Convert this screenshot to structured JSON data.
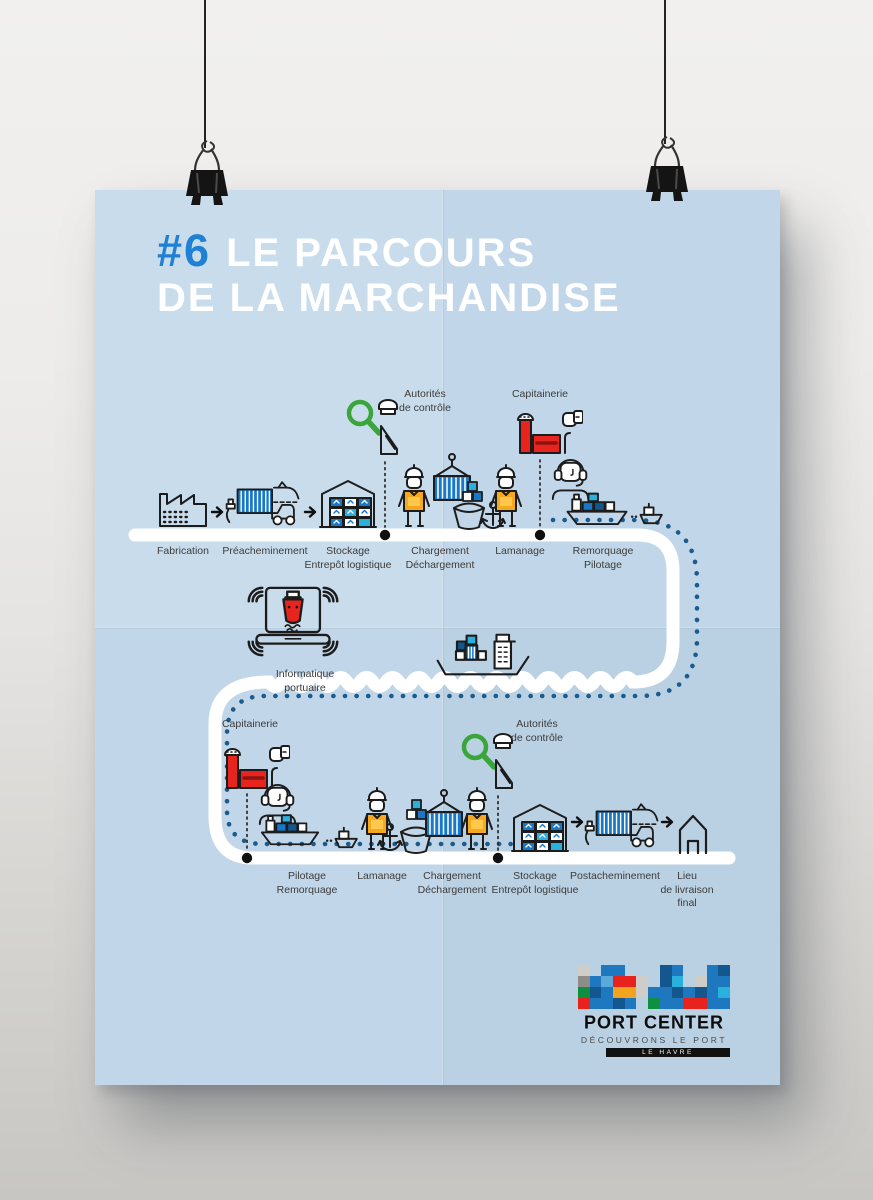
{
  "poster": {
    "title": {
      "number": "#6",
      "line1": "LE PARCOURS",
      "line2": "DE LA MARCHANDISE"
    },
    "top_route": {
      "callouts": {
        "autorites": "Autorités\nde contrôle",
        "capitainerie": "Capitainerie"
      },
      "steps": [
        "Fabrication",
        "Préacheminement",
        "Stockage\nEntrepôt logistique",
        "Chargement\nDéchargement",
        "Lamanage",
        "Remorquage\nPilotage"
      ]
    },
    "middle": {
      "informatique": "Informatique\nportuaire"
    },
    "bottom_route": {
      "callouts": {
        "capitainerie": "Capitainerie",
        "autorites": "Autorités\nde contrôle"
      },
      "steps": [
        "Pilotage\nRemorquage",
        "Lamanage",
        "Chargement\nDéchargement",
        "Stockage\nEntrepôt logistique",
        "Postacheminement",
        "Lieu\nde livraison\nfinal"
      ]
    },
    "logo": {
      "name": "PORT CENTER",
      "tagline": "DÉCOUVRONS LE PORT",
      "city": "LE HAVRE",
      "palette": {
        "B": "#1d78c0",
        "N": "#14568e",
        "S": "#5aa9da",
        "C": "#2ab0dc",
        "R": "#e8231d",
        "G": "#0e9040",
        "Y": "#f2a41f",
        "L": "#cfcdc8",
        "D": "#8e8c88"
      },
      "mosaic": [
        "L.BB...NB..BN",
        "DBSRRL.NC.LBB",
        "GNBYYLBBNBNBC",
        "RBBNB.GBBRRBB"
      ]
    },
    "colors": {
      "paper_blue": "#c8dcec",
      "accent_blue": "#1e81d6",
      "container_blue": "#1878c8",
      "cyan": "#2ab0dc",
      "red": "#e8241e",
      "vest_yellow": "#f6a81f",
      "green": "#3aa53a",
      "route_white": "#ffffff",
      "sea_dot_navy": "#1a5c8e"
    }
  }
}
